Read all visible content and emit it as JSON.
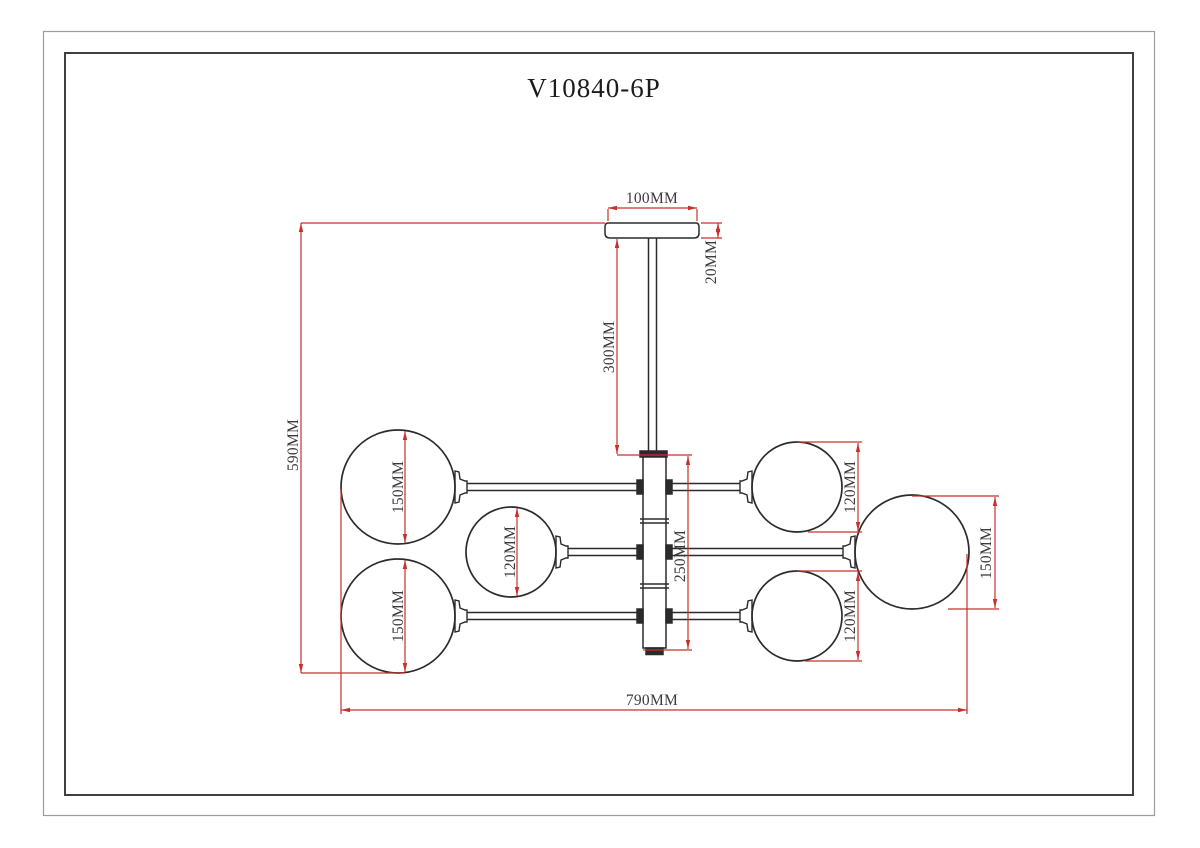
{
  "drawing": {
    "product_code": "V10840-6P",
    "units": "MM",
    "colors": {
      "dimension_lines": "#c8302c",
      "outline": "#2b2b2b",
      "label_text": "#3a3a3a",
      "border_outer": "#9c9c9c",
      "border_inner": "#404040"
    },
    "dimensions": {
      "canopy_width": "100MM",
      "canopy_height": "20MM",
      "stem_length": "300MM",
      "overall_height": "590MM",
      "body_height": "250MM",
      "overall_width": "790MM",
      "globe_top_left": "150MM",
      "globe_middle_left": "120MM",
      "globe_bottom_left": "150MM",
      "globe_top_right": "120MM",
      "globe_bottom_right": "120MM",
      "globe_far_right": "150MM"
    }
  }
}
